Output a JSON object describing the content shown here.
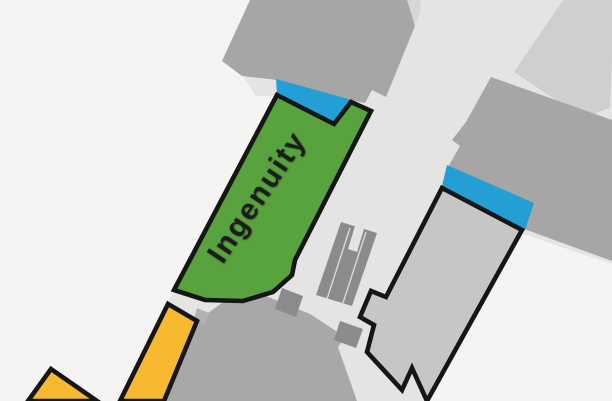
{
  "map": {
    "label_ingenuity": "Ingenuity",
    "colors": {
      "background": "#f5f4f2",
      "walkway": "#e4e4e3",
      "building": "#a6a6a6",
      "building_light": "#cfcfcf",
      "building_lighter": "#d6d6d5",
      "plaza": "#a8a8a8",
      "fixture_dark": "#8a8b8d",
      "tick": "#b3b3b3",
      "entrance_blue": "#239fd6",
      "store_green": "#58a33e",
      "store_gray": "#c6c6c6",
      "store_yellow": "#f7b92f",
      "outline": "#161616",
      "label_color": "#1c1c1c"
    },
    "features": [
      {
        "name": "walkway",
        "kind": "walkway"
      },
      {
        "name": "building-north",
        "kind": "building"
      },
      {
        "name": "building-north-back",
        "kind": "building"
      },
      {
        "name": "building-northeast",
        "kind": "building"
      },
      {
        "name": "building-east",
        "kind": "building"
      },
      {
        "name": "plaza-lower",
        "kind": "terrace"
      },
      {
        "name": "escalator",
        "kind": "fixture"
      },
      {
        "name": "kiosk-1",
        "kind": "fixture"
      },
      {
        "name": "kiosk-2",
        "kind": "fixture"
      },
      {
        "name": "entrance-north",
        "kind": "entrance"
      },
      {
        "name": "entrance-east",
        "kind": "entrance"
      },
      {
        "name": "store-ingenuity",
        "kind": "store",
        "label": "Ingenuity"
      },
      {
        "name": "store-southeast",
        "kind": "store"
      },
      {
        "name": "store-yellow-south",
        "kind": "store"
      },
      {
        "name": "store-yellow-corner",
        "kind": "store"
      }
    ]
  }
}
